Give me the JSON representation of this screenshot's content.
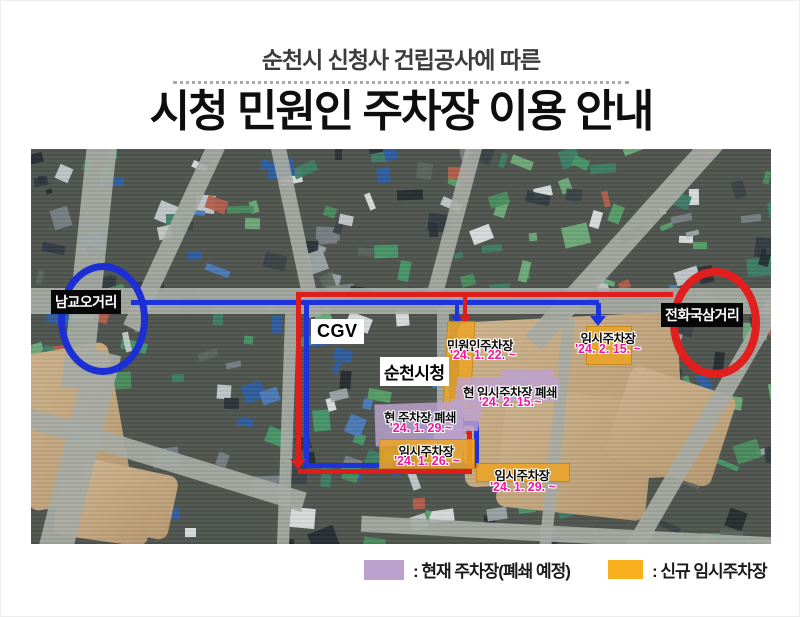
{
  "poster": {
    "subtitle": "순천시 신청사 건립공사에 따른",
    "title": "시청 민원인 주차장 이용 안내"
  },
  "map": {
    "intersections": [
      {
        "label": "남교오거리",
        "ring_color": "#1b2fd4"
      },
      {
        "label": "전화국삼거리",
        "ring_color": "#e11f1f"
      }
    ],
    "places": [
      {
        "label": "CGV"
      },
      {
        "label": "순천시청"
      }
    ],
    "parking_labels": [
      {
        "title": "민원인주차장",
        "date": "'24. 1. 22. ~",
        "kind": "new-temp"
      },
      {
        "title": "임시주차장",
        "date": "'24. 2. 15. ~",
        "kind": "new-temp"
      },
      {
        "title": "현 임시주차장 폐쇄",
        "date": "'24. 2. 15.~",
        "kind": "closing"
      },
      {
        "title": "현 주차장 폐쇄",
        "date": "'24. 1. 29.~",
        "kind": "closing"
      },
      {
        "title": "임시주차장",
        "date": "'24. 1. 26. ~",
        "kind": "new-temp"
      },
      {
        "title": "임시주차장",
        "date": "'24. 1. 29. ~",
        "kind": "new-temp"
      }
    ],
    "route_colors": {
      "blue": "#1c33dd",
      "red": "#e01d1d"
    }
  },
  "legend": {
    "items": [
      {
        "swatch_color": "#b9a0cd",
        "label": ": 현재 주차장(폐쇄 예정)"
      },
      {
        "swatch_color": "#f9b01e",
        "label": ": 신규 임시주차장"
      }
    ]
  },
  "colors": {
    "date_highlight": "#ec189f",
    "new_temp_parking": "#eba428",
    "closing_parking": "#bca2d0"
  }
}
